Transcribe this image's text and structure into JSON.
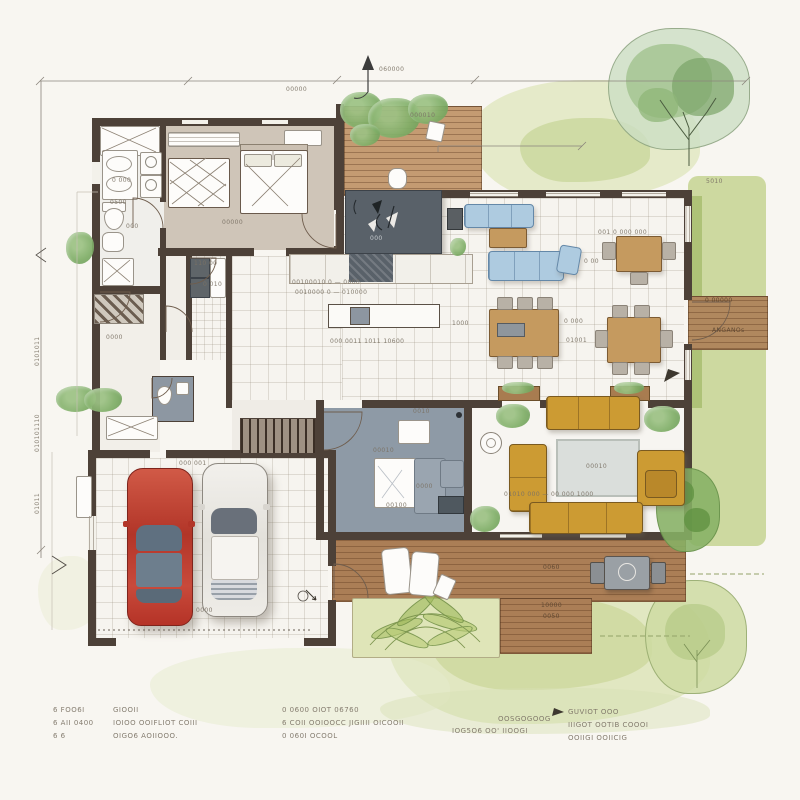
{
  "drawing": {
    "type": "residential floor plan, watercolor hand-sketch, top view",
    "palette": {
      "paper": "#f8f6f1",
      "wall": "#4d4138",
      "wood_deck": "#ab7e56",
      "wood_furniture": "#c59a5f",
      "lawn": "#ccd9a2",
      "foliage": "#8fbc72",
      "bedroom_floor": "#cfc5b8",
      "office_floor": "#8e9aa6",
      "kitchen_slab": "#596169",
      "sofa_blue": "#aecbe0",
      "sofa_mustard": "#cc9b33",
      "car_red": "#c7423a",
      "rug_grey": "#d9dcd8",
      "ink": "#7b7265"
    }
  },
  "dimensions": {
    "top_note": "00000",
    "north_note": "060000",
    "left_note_1": "0101011",
    "left_note_2": "010101110",
    "left_note_3": "01011",
    "deck_note": "000010",
    "lawn_note": "5010"
  },
  "rooms": {
    "bedroom": "00000",
    "bath_note_1": "0 000",
    "bath_note_2": "0500",
    "bath_note_3": "000",
    "utility_note_1": "110 00",
    "utility_note_2": "0 010",
    "hall_note": "0000",
    "kitchen_note_1": "00100010 0 — 0000",
    "kitchen_note_2": "0010000 0 — 010000",
    "slab_note": "000",
    "island_note": "000 0011 1011 10600",
    "dining_note_top": "001 0 000 000",
    "dining_note_1": "0 000",
    "dining_note_2": "01001",
    "dining_note_3": "1000",
    "sofa_note": "0 00",
    "living_rug_note": "00010",
    "living_note": "01010 000 — 00 000 1000",
    "office_note_1": "0010",
    "office_note_2": "00010",
    "office_note_3": "0000",
    "office_note_4": "00100",
    "garage_note_1": "000 001",
    "garage_note_2": "0000",
    "deck_note_1": "0060",
    "deck_note_2": "10000",
    "deck_note_3": "0050",
    "porch_note_1": "0 00000",
    "porch_note_2": "ANGANOs"
  },
  "legend": {
    "col1": [
      "6  FOO6I",
      "6  AII 0400",
      "6  6"
    ],
    "col2": [
      "GIOOII",
      "IOIOO OOIFLIOT COIII",
      "OIGO6 AOIIOOO."
    ],
    "col3": [
      "0  0600 OIOT 06760",
      "6  COII OOIOOCC JIGIIII OICOOII",
      "0  060I OCOOL"
    ],
    "col4": [
      "OOSGOGOOG",
      "IOG5O6 OO' IIOOGI"
    ],
    "col5": [
      "GUVIOT OOO",
      "IIIGOT OOTIB COOOI",
      "OOIIGI OOIICIG"
    ]
  }
}
